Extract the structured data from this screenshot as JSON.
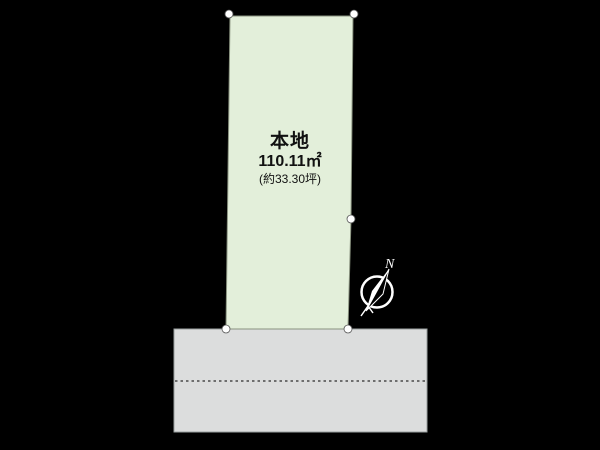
{
  "canvas": {
    "width": 600,
    "height": 450,
    "background": "#000000"
  },
  "plot": {
    "label": "本地",
    "area_m2": "110.11㎡",
    "area_tsubo": "(約33.30坪)",
    "fill": "#e3efda",
    "stroke": "#89927f",
    "polygon_points": "230,16 353,16 351,219 348,329 226,329"
  },
  "vertices": [
    {
      "x": 229,
      "y": 14
    },
    {
      "x": 354,
      "y": 14
    },
    {
      "x": 351,
      "y": 219
    },
    {
      "x": 226,
      "y": 329
    },
    {
      "x": 348,
      "y": 329
    }
  ],
  "vertex_style": {
    "fill": "#ffffff",
    "stroke": "#555555",
    "r": 4
  },
  "road": {
    "fill": "#dcdddd",
    "stroke": "#9aa0a0",
    "x": 174,
    "y": 329,
    "width": 253,
    "height": 103,
    "centerline": {
      "x1": 175,
      "y1": 381,
      "x2": 426,
      "y2": 381,
      "color": "#4a4a4a"
    }
  },
  "compass": {
    "label": "N",
    "color": "#ffffff",
    "cx": 377,
    "cy": 292,
    "r": 15.5
  }
}
